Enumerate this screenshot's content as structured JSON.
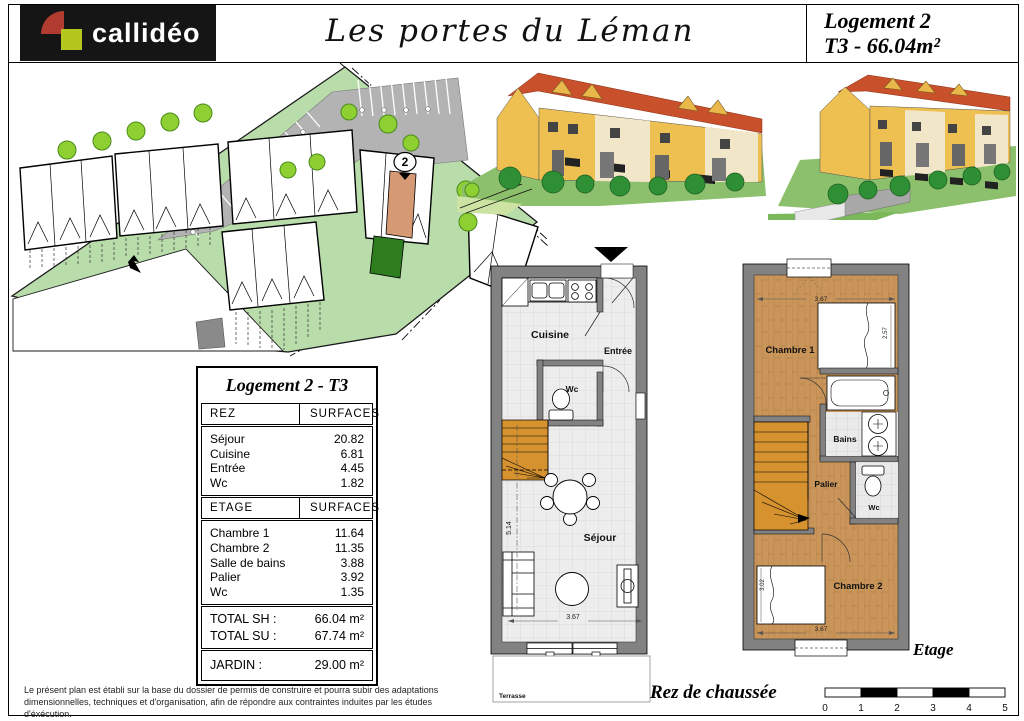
{
  "header": {
    "logo_text": "callidéo",
    "project_title": "Les portes du Léman",
    "unit_line1": "Logement 2",
    "unit_line2": "T3 - 66.04m²"
  },
  "site_plan": {
    "unit_marker": "2"
  },
  "surface_table": {
    "title": "Logement 2 - T3",
    "rez": {
      "col1": "REZ",
      "col2": "SURFACES",
      "rows": [
        {
          "label": "Séjour",
          "value": "20.82"
        },
        {
          "label": "Cuisine",
          "value": "6.81"
        },
        {
          "label": "Entrée",
          "value": "4.45"
        },
        {
          "label": "Wc",
          "value": "1.82"
        }
      ]
    },
    "etage": {
      "col1": "ETAGE",
      "col2": "SURFACES",
      "rows": [
        {
          "label": "Chambre 1",
          "value": "11.64"
        },
        {
          "label": "Chambre 2",
          "value": "11.35"
        },
        {
          "label": "Salle de bains",
          "value": "3.88"
        },
        {
          "label": "Palier",
          "value": "3.92"
        },
        {
          "label": "Wc",
          "value": "1.35"
        }
      ]
    },
    "totals": [
      {
        "label": "TOTAL SH :",
        "value": "66.04 m²"
      },
      {
        "label": "TOTAL SU :",
        "value": "67.74 m²"
      }
    ],
    "jardin": {
      "label": "JARDIN :",
      "value": "29.00 m²"
    }
  },
  "ground_floor": {
    "caption": "Rez de chaussée",
    "rooms": {
      "cuisine": "Cuisine",
      "entree": "Entrée",
      "wc": "Wc",
      "sejour": "Séjour"
    },
    "terrasse": "Terrasse",
    "dims": {
      "height": "5.14",
      "width": "3.67"
    }
  },
  "upper_floor": {
    "caption": "Etage",
    "rooms": {
      "chambre1": "Chambre 1",
      "bains": "Bains",
      "palier": "Palier",
      "wc": "Wc",
      "chambre2": "Chambre 2"
    },
    "dims": {
      "top": "3.67",
      "right": "2.57",
      "left": "3.02",
      "bottom": "3.67"
    }
  },
  "footer": {
    "disclaimer_line1": "Le présent plan est établi sur la base du dossier de permis de construire et pourra subir des adaptations",
    "disclaimer_line2": "dimensionnelles, techniques et d'organisation, afin de répondre aux contraintes induites par les études d'éxécution.",
    "scale_ticks": [
      "0",
      "1",
      "2",
      "3",
      "4",
      "5"
    ]
  },
  "colors": {
    "site_green": "#b9dcab",
    "tree_green": "#8ed032",
    "parking_gray": "#b3b3b3",
    "unit_highlight": "#d59a74",
    "garden_green": "#2e7d1e",
    "roof_red": "#c8502a",
    "facade_yellow": "#eec052",
    "facade_cream": "#f2e6c8",
    "render_lawn": "#8cc06c",
    "wood_floor": "#c9955a",
    "stair_wood": "#d6922f",
    "wall_gray": "#828282",
    "logo_red": "#b23b30",
    "logo_green": "#b5c61e"
  }
}
